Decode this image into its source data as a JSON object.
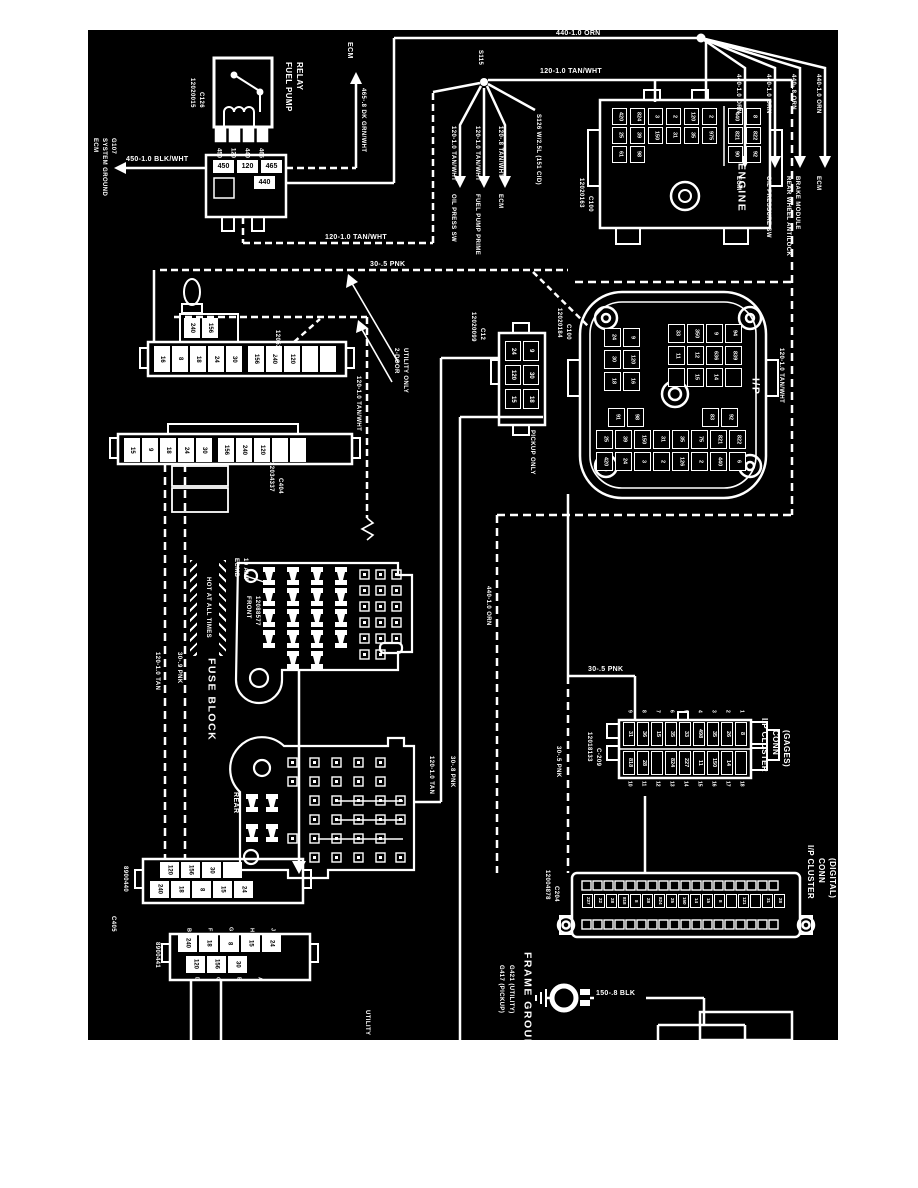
{
  "relay": {
    "title_l1": "FUEL PUMP",
    "title_l2": "RELAY",
    "part": "12020015",
    "conn": "C126",
    "pins": [
      "450",
      "120",
      "440",
      "465"
    ],
    "conn_cells": [
      "450",
      "120",
      "465"
    ],
    "conn_cell_440": "440"
  },
  "ecm_ground": {
    "l1": "ECM",
    "l2": "SYSTEM GROUND",
    "l3": "G107"
  },
  "w": {
    "blkwht": "450-1.0 BLK/WHT",
    "dkgrn": "465-.8 DK GRN/WHT",
    "tanwht": "120-1.0 TAN/WHT",
    "tanwht8": "120-.8 TAN/WHT",
    "orn": "440-1.0 ORN",
    "orn8": "440-.8 ORN",
    "pnk5": "30-.5 PNK",
    "pnk8": "30-.8 PNK",
    "pnk9": "30-.9 PNK",
    "tan": "120-1.0 TAN",
    "blk": "150-.8 BLK",
    "ecm": "ECM"
  },
  "s115": {
    "id": "S115",
    "b1_dest": "OIL PRESS SW",
    "b2_dest": "FUEL PUMP PRIME",
    "b3_dest": "ECM",
    "s126": "S126 W/2.5L (151 CID)"
  },
  "orn_fan": {
    "d1": "ECM",
    "d2": "OIL PRESSURE SW",
    "d3a": "REAR WHEEL ANTILOCK",
    "d3b": "BRAKE MODULE",
    "d4": "ECM"
  },
  "engine": {
    "label": "ENGINE",
    "part": "12020163",
    "conn": "C100",
    "cols": [
      [
        "420",
        "25",
        "61"
      ],
      [
        "824",
        "39",
        "98"
      ],
      [
        "3",
        "150"
      ],
      [
        "2",
        "31"
      ],
      [
        "120",
        "35"
      ],
      [
        "2",
        "975"
      ],
      [
        "440",
        "821",
        "90"
      ],
      [
        "8",
        "822",
        "92"
      ]
    ]
  },
  "utility2door": {
    "l1": "2-DOOR",
    "l2": "UTILITY ONLY"
  },
  "c404a": {
    "part": "12052469",
    "conn": "C404",
    "top_cells": [
      "240",
      "156"
    ],
    "cells1": [
      "16",
      "8",
      "18",
      "24",
      "30"
    ],
    "cells2": [
      "156",
      "240",
      "120",
      "",
      ""
    ]
  },
  "c404b": {
    "part": "12034337",
    "conn": "C404",
    "cells1": [
      "15",
      "9",
      "18",
      "24",
      "30"
    ],
    "cells2": [
      "156",
      "240",
      "120",
      "",
      ""
    ]
  },
  "c12": {
    "part": "12020099",
    "conn": "C12",
    "note": "PICKUP ONLY",
    "cells": [
      [
        "24",
        "9"
      ],
      [
        "120",
        "30"
      ],
      [
        "15",
        "18"
      ]
    ]
  },
  "ip": {
    "label": "I/P",
    "part": "12020184",
    "conn": "C100",
    "a": [
      [
        "24",
        "9"
      ],
      [
        "30",
        "120"
      ],
      [
        "18",
        "16"
      ]
    ],
    "b": [
      [
        "33",
        "350",
        "9",
        "94"
      ],
      [
        "11",
        "12",
        "636",
        "839"
      ],
      [
        "",
        "15",
        "14",
        ""
      ]
    ],
    "c_l": [
      "91",
      "98"
    ],
    "c_r": [
      "83",
      "92"
    ],
    "c1": [
      "25",
      "39",
      "150",
      "31",
      "35",
      "75",
      "821",
      "822"
    ],
    "c2": [
      "420",
      "24",
      "3",
      "2",
      "126",
      "2",
      "440",
      "6"
    ]
  },
  "fuse_front": {
    "ecmb_l1": "ECMB",
    "ecmb_l2": "10 AMP",
    "hot": "HOT AT ALL TIMES",
    "front": "FRONT",
    "part": "12088577",
    "label": "FUSE BLOCK"
  },
  "rear": {
    "label": "REAR"
  },
  "c405a": {
    "part": "8900440",
    "conn": "C405",
    "row1": [
      "120",
      "156",
      "30",
      ""
    ],
    "row2": [
      "240",
      "18",
      "8",
      "15",
      "24"
    ]
  },
  "c405b": {
    "part": "8900441",
    "letters_top": [
      "B",
      "F",
      "G",
      "H",
      "J"
    ],
    "row1": [
      "240",
      "18",
      "8",
      "15",
      "24"
    ],
    "row2": [
      "120",
      "156",
      "30"
    ],
    "letters_bot": [
      "D",
      "C",
      "B",
      "A"
    ]
  },
  "gages": {
    "part": "12018133",
    "conn": "C-209",
    "t1": "I/P CLUSTER",
    "t2": "CONN",
    "t3": "(GAGES)",
    "nums_top": [
      "9",
      "8",
      "7",
      "6",
      "5",
      "4",
      "3",
      "2",
      "1"
    ],
    "cells_top": [
      "31",
      "36",
      "15",
      "35",
      "33",
      "498",
      "35",
      "26",
      "8"
    ],
    "cells_bot": [
      "818",
      "28",
      "",
      "824",
      "227",
      "11",
      "150",
      "14",
      ""
    ],
    "nums_bot": [
      "10",
      "11",
      "12",
      "13",
      "14",
      "15",
      "16",
      "17",
      "18"
    ]
  },
  "digital": {
    "part": "12004878",
    "conn": "C204",
    "t1": "I/P CLUSTER",
    "t2": "CONN",
    "t3": "(DIGITAL)",
    "cells": [
      "227",
      "22",
      "28",
      "818",
      "8",
      "28",
      "824",
      "25",
      "150",
      "14",
      "15",
      "8",
      "",
      "121",
      "",
      "31",
      "28"
    ]
  },
  "ground": {
    "label": "FRAME GROUND",
    "g1": "G417 (PICKUP)",
    "g2": "G421 (UTILITY)"
  },
  "bottom_note": "UTILITY"
}
